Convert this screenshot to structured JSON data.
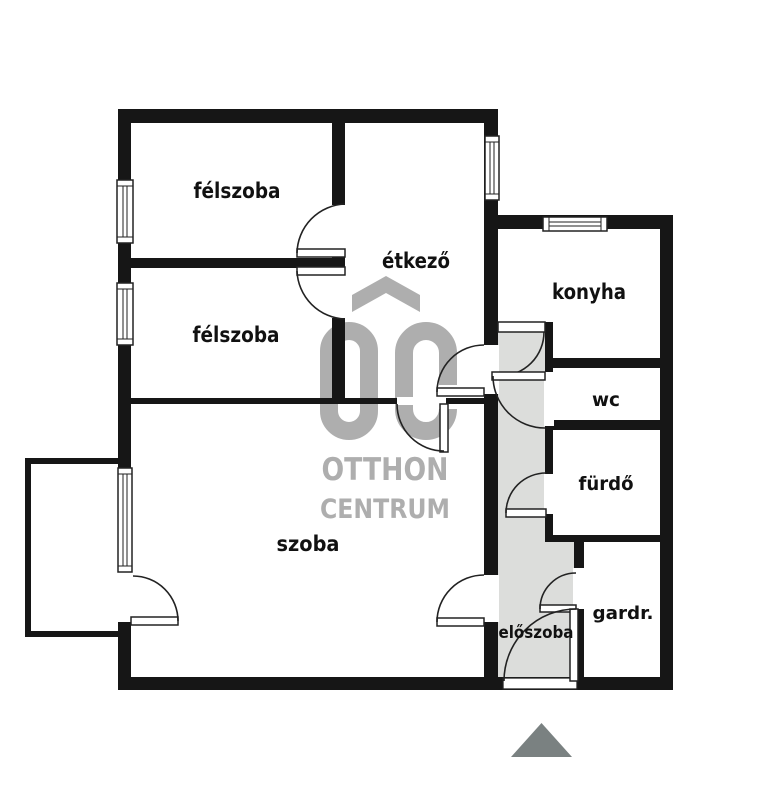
{
  "rooms": [
    {
      "label": "félszoba"
    },
    {
      "label": "félszoba"
    },
    {
      "label": "étkező"
    },
    {
      "label": "konyha"
    },
    {
      "label": "wc"
    },
    {
      "label": "fürdő"
    },
    {
      "label": "szoba"
    },
    {
      "label": "gardr."
    },
    {
      "label": "előszoba"
    }
  ],
  "watermark": {
    "brand_top": "OTTHON",
    "brand_bottom": "CENTRUM"
  },
  "colors": {
    "wall": "#161616",
    "hallway_fill": "#dcdddb",
    "watermark_gray": "#aeaeae",
    "entrance_marker": "#7a8181"
  }
}
